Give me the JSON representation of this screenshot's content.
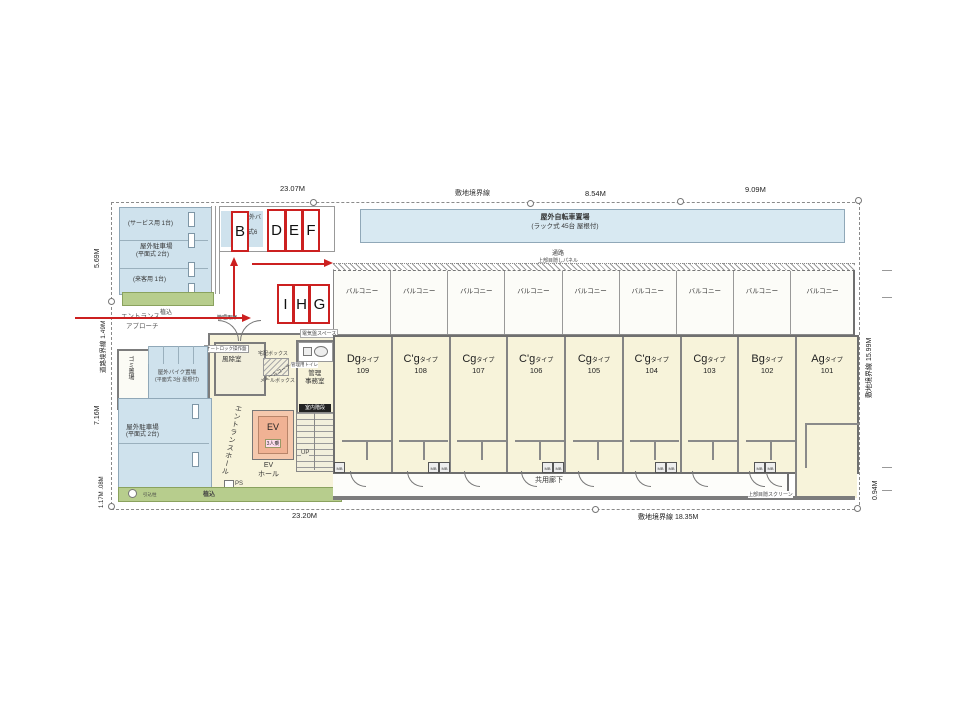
{
  "boundary": {
    "top_dim1": "23.07M",
    "top_label": "敷地境界線",
    "top_dim2": "8.54M",
    "top_dim3": "9.09M",
    "bottom_dim": "23.20M",
    "bottom_label": "敷地境界線 18.35M",
    "left_dim1": "5.69M",
    "left_label": "道路境界線 1.49M",
    "left_dim2": "7.16M",
    "left_dim3": "1.17M .08M",
    "right_label": "敷地境界線 15.99M",
    "right_dim": "0.94M"
  },
  "site": {
    "bicycle_line1": "屋外自転車置場",
    "bicycle_line2": "(ラック式 45台 屋根付)",
    "parking_top_line1": "(サービス用 1台)",
    "parking_top_line2": "屋外駐車場",
    "parking_top_line3": "(平面式 2台)",
    "parking_top_line4": "(来客用 1台)",
    "bike_rack_frag1": "外バ",
    "bike_rack_frag2": "式6",
    "garbage": "ゴミ置場",
    "bike_left_line1": "屋外バイク置場",
    "bike_left_line2": "(平面式 3台 屋根付)",
    "parking_left_line1": "屋外駐車場",
    "parking_left_line2": "(平面式 2台)",
    "planting_top": "植込",
    "planting_bottom": "植込",
    "pole": "引込柱",
    "approach_line1": "エントランス",
    "approach_line2": "アプローチ",
    "walkway": "通路",
    "panel": "上部目隠しパネル",
    "screen": "上部目隠スクリーン",
    "laundry": "物干金物"
  },
  "building": {
    "balcony_label": "バルコニー",
    "type_suffix": "タイプ",
    "units": [
      {
        "type": "Dg",
        "number": "109"
      },
      {
        "type": "C'g",
        "number": "108"
      },
      {
        "type": "Cg",
        "number": "107"
      },
      {
        "type": "C'g",
        "number": "106"
      },
      {
        "type": "Cg",
        "number": "105"
      },
      {
        "type": "C'g",
        "number": "104"
      },
      {
        "type": "Cg",
        "number": "103"
      },
      {
        "type": "Bg",
        "number": "102"
      },
      {
        "type": "Ag",
        "number": "101"
      }
    ],
    "corridor": "共用廊下",
    "mb": "MB",
    "windbreak": "風除室",
    "autolock": "オートロック操作盤",
    "delivery": "宅配ボックス",
    "mail_corner": "メールコーナー",
    "mailbox": "メールボックス",
    "office_l1": "管理",
    "office_l2": "事務室",
    "office_toilet": "管理用トイレ",
    "hall": "エントランスホール",
    "ev": "EV",
    "ev_cap": "3人乗",
    "ev_hall_l1": "EV",
    "ev_hall_l2": "ホール",
    "stairs": "室内階段",
    "up": "UP",
    "ps": "PS",
    "elec": "電気盤スペース",
    "door_note": "管理用扉"
  },
  "annotations": {
    "b": "B",
    "d": "D",
    "e": "E",
    "f": "F",
    "i": "I",
    "h": "H",
    "g": "G"
  },
  "colors": {
    "red": "#cc2020",
    "area_blue": "#cfe2ed",
    "unit_cream": "#f7f3da",
    "green": "#b7cd8d",
    "ev_orange": "#f0b294"
  }
}
